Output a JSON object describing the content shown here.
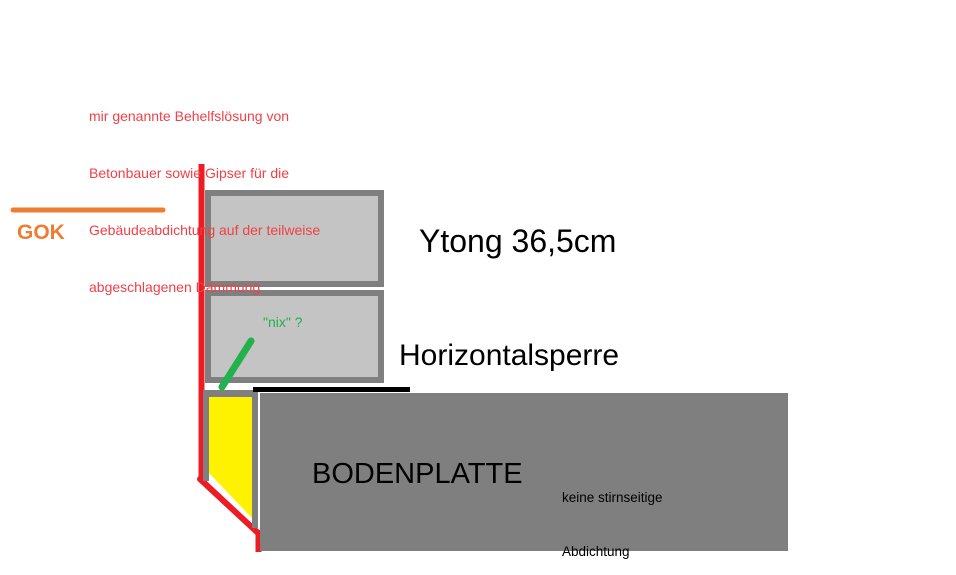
{
  "colors": {
    "red": "#ED1C24",
    "red_text": "#F04147",
    "orange": "#ED7D31",
    "green": "#22B14C",
    "yellow": "#FFF200",
    "block_fill": "#C4C4C4",
    "gray": "#7F7F7F",
    "black": "#000000"
  },
  "annotation": {
    "lines": [
      "mir genannte Behelfslösung von",
      "Betonbauer sowie Gipser für die",
      "Gebäudeabdichtung auf der teilweise",
      "abgeschlagenen Dämmung"
    ]
  },
  "labels": {
    "gok": "GOK",
    "ytong": "Ytong 36,5cm",
    "nix": "\"nix\" ?",
    "horizontalsperre": "Horizontalsperre",
    "bodenplatte": "BODENPLATTE",
    "keine_line1": "keine stirnseitige",
    "keine_line2": "Abdichtung"
  }
}
